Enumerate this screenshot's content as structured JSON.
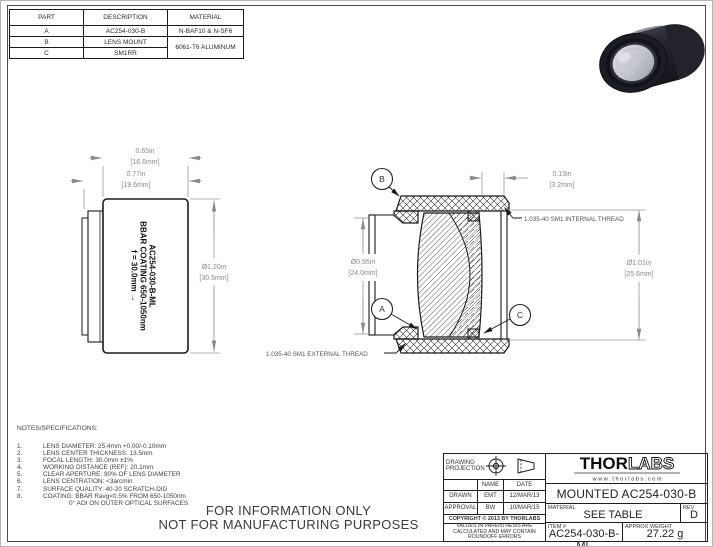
{
  "colors": {
    "line": "#1a1a1a",
    "dim": "#8a8a8a",
    "text": "#333333"
  },
  "parts_table": {
    "headers": [
      "PART",
      "DESCRIPTION",
      "MATERIAL"
    ],
    "rows": [
      {
        "part": "A",
        "description": "AC254-030-B",
        "material": "N-BAF10 & N-SF6"
      },
      {
        "part": "B",
        "description": "LENS MOUNT",
        "material": "6061-T6 ALUMINUM"
      },
      {
        "part": "C",
        "description": "SM1RR"
      }
    ]
  },
  "side_view": {
    "engraving": [
      "AC254-030-B-ML",
      "BBAR COATING 650-1050nm",
      "f = 30.0mm →"
    ],
    "dims": {
      "face_width_in": "0.65in",
      "face_width_mm": "[16.6mm]",
      "overall_width_in": "0.77in",
      "overall_width_mm": "[19.6mm]",
      "outer_dia_in": "Ø1.20in",
      "outer_dia_mm": "[30.5mm]"
    }
  },
  "section_view": {
    "balloons": {
      "a": "A",
      "b": "B",
      "c": "C"
    },
    "dims": {
      "ring_depth_in": "0.13in",
      "ring_depth_mm": "[3.2mm]",
      "clear_aperture_in": "Ø0.95in",
      "clear_aperture_mm": "[24.0mm]",
      "thread_dia_in": "Ø1.01in",
      "thread_dia_mm": "[25.6mm]"
    },
    "internal_thread": "1.035-40 SM1  INTERNAL THREAD",
    "external_thread": "1.035-40 SM1 EXTERNAL THREAD"
  },
  "notes": {
    "title": "NOTES/SPECIFICATIONS:",
    "items": [
      "LENS DIAMETER: 25.4mm +0.00/-0.10mm",
      "LENS CENTER THICKNESS: 13.5mm",
      "FOCAL LENGTH: 30.0mm ±1%",
      "WORKING DISTANCE (REF): 20.1mm",
      "CLEAR APERTURE: 90% OF LENS DIAMETER",
      "LENS CENTRATION: <3arcmin",
      "SURFACE QUALITY: 40-20 SCRATCH-DIG",
      "COATING: BBAR Ravg<0.5% FROM  650-1050nm"
    ],
    "item8_cont": "0° AOI ON OUTER OPTICAL SURFACES"
  },
  "footer": {
    "line1": "FOR INFORMATION ONLY",
    "line2": "NOT FOR MANUFACTURING PURPOSES"
  },
  "title_block": {
    "projection_label": "DRAWING PROJECTION",
    "name_header": "NAME",
    "date_header": "DATE",
    "drawn_label": "DRAWN",
    "drawn_name": "EMT",
    "drawn_date": "12/MAR/13",
    "approval_label": "APPROVAL",
    "approval_name": "BW",
    "approval_date": "10/MAR/15",
    "copyright": "COPYRIGHT © 2013 BY THORLABS",
    "disclaimer": "VALUES IN PARENTHESIS ARE CALCULATED AND MAY CONTAIN ROUNDOFF ERRORS",
    "logo_thor": "THOR",
    "logo_labs": "LABS",
    "website": "w w w . t h o r l a b s . c o m",
    "product_title": "MOUNTED AC254-030-B",
    "material_label": "MATERIAL",
    "material_value": "SEE TABLE",
    "rev_label": "REV",
    "rev_value": "D",
    "item_label": "ITEM #",
    "item_value": "AC254-030-B-ML",
    "weight_label": "APPROX WEIGHT",
    "weight_value": "27.22 g"
  }
}
